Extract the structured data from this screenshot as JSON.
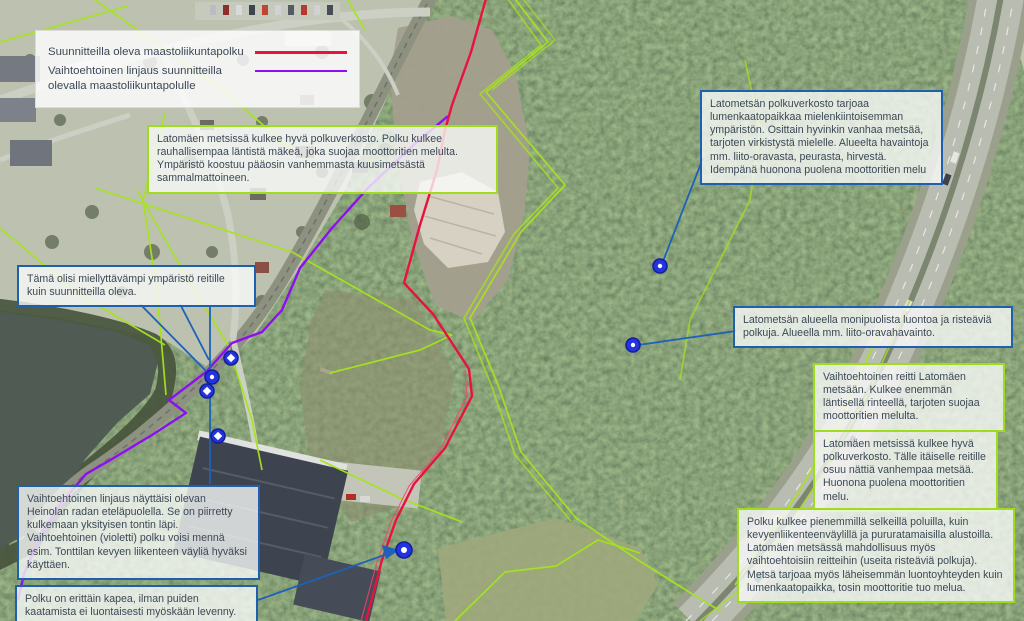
{
  "legend": {
    "items": [
      {
        "label": "Suunnitteilla oleva maastoliikuntapolku",
        "color": "#e8123f"
      },
      {
        "label": "Vaihtoehtoinen linjaus suunnitteilla olevalla maastoliikuntapolulle",
        "color": "#8d0ff0"
      }
    ]
  },
  "callouts": [
    {
      "id": "west-forest",
      "style": "green",
      "text": "Latomäen metsissä kulkee hyvä polkuverkosto. Polku kulkee rauhallisempaa läntistä mäkeä, joka suojaa moottoritien melulta. Ympäristö koostuu pääosin vanhemmasta kuusimetsästä sammalmattoineen."
    },
    {
      "id": "lato-network",
      "style": "blue",
      "text": "Latometsän polkuverkosto tarjoaa lumenkaatopaikkaa mielenkiintoisemman ympäristön. Osittain hyvinkin vanhaa metsää, tarjoten virkistystä mielelle. Alueelta havaintoja mm. liito-oravasta, peurasta, hirvestä. Idempänä huonona puolena moottoritien melu"
    },
    {
      "id": "nicer-environment",
      "style": "blue",
      "text": "Tämä olisi miellyttävämpi ympäristö reitille kuin suunnitteilla oleva."
    },
    {
      "id": "diverse-nature",
      "style": "blue",
      "text": "Latometsän alueella monipuolista luontoa ja risteäviä polkuja. Alueella mm. liito-oravahavainto."
    },
    {
      "id": "alt-route",
      "style": "green",
      "text": "Vaihtoehtoinen reitti Latomäen metsään. Kulkee enemmän läntisellä rinteellä, tarjoten suojaa moottoritien melulta."
    },
    {
      "id": "east-route",
      "style": "green",
      "text": "Latomäen metsissä kulkee hyvä polkuverkosto. Tälle itäiselle reitille osuu nättiä vanhempaa metsää. Huonona puolena moottoritien melu."
    },
    {
      "id": "small-paths",
      "style": "green",
      "text": "Polku kulkee pienemmillä selkeillä poluilla, kuin kevyenliikenteenväylillä ja pururatamaisilla alustoilla. Latomäen metsässä mahdollisuus myös vaihtoehtoisiin reitteihin (useita risteäviä polkuja). Metsä tarjoaa myös läheisemmän luontoyhteyden kuin lumenkaatopaikka, tosin moottoritie tuo melua."
    },
    {
      "id": "private-lot",
      "style": "blue",
      "text": "Vaihtoehtoinen linjaus näyttäisi olevan Heinolan radan eteläpuolella. Se on piirretty kulkemaan yksityisen tontin läpi. Vaihtoehtoinen (violetti) polku voisi mennä esim. Tonttilan kevyen liikenteen väyliä hyväksi käyttäen."
    },
    {
      "id": "narrow-path",
      "style": "blue",
      "text": "Polku on erittäin kapea, ilman puiden kaatamista ei luontaisesti myöskään levenny."
    }
  ],
  "colors": {
    "planned_route": "#e8123f",
    "alternative_route": "#8d0ff0",
    "drawn_trail": "#a6e41c",
    "callout_border_green": "#a0dc1e",
    "callout_border_blue": "#1e5fae",
    "leader_line": "#1d61b8",
    "marker_fill": "#2433e0"
  }
}
